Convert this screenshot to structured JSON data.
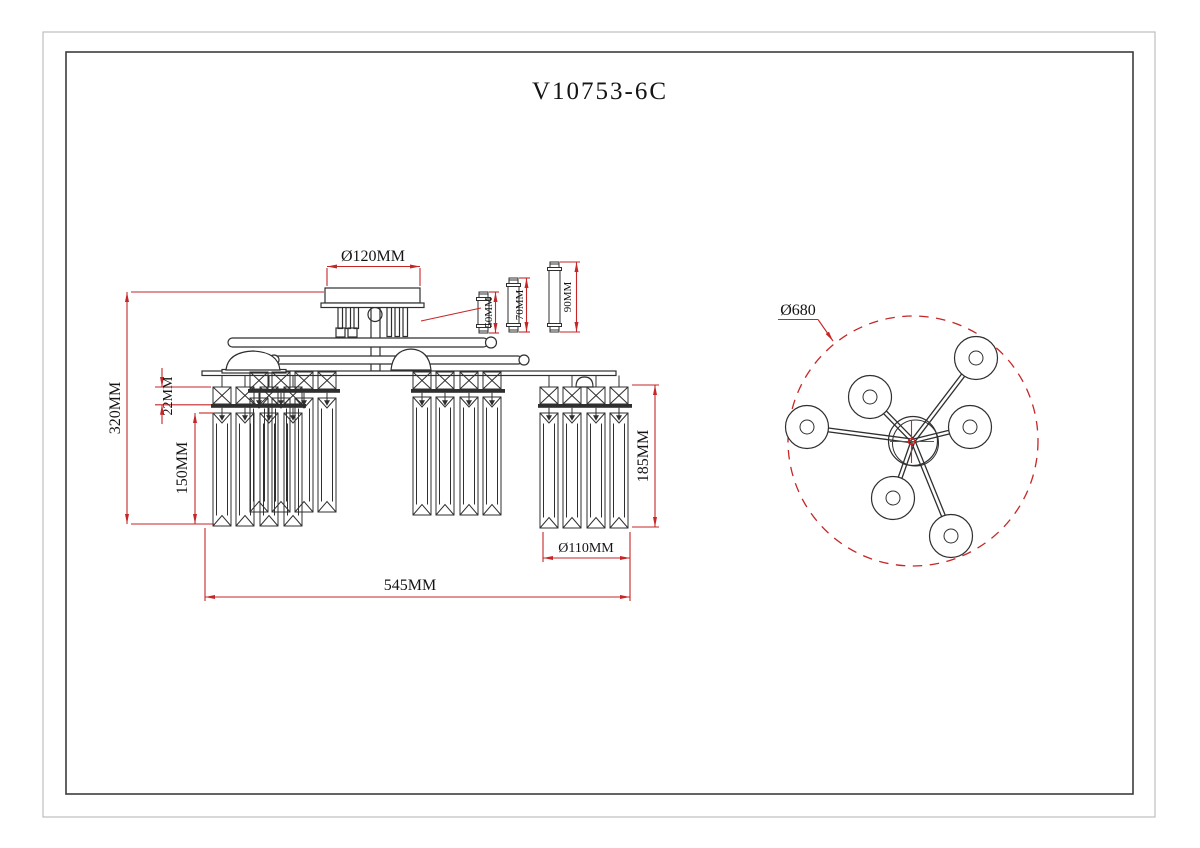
{
  "title": "V10753-6C",
  "front_view": {
    "dim_canopy_diameter": "Ø120MM",
    "dim_overall_height": "320MM",
    "dim_cube_height": "22MM",
    "dim_prism_length_left": "150MM",
    "dim_drop_length_right": "185MM",
    "dim_shade_diameter": "Ø110MM",
    "dim_overall_width": "545MM",
    "pipe_lengths": [
      "50MM",
      "70MM",
      "90MM"
    ]
  },
  "top_view": {
    "dim_overall_diameter": "Ø680",
    "shade_count": 6
  },
  "colors": {
    "dimension_red": "#c62626",
    "drawing_black": "#2f2f2f"
  }
}
